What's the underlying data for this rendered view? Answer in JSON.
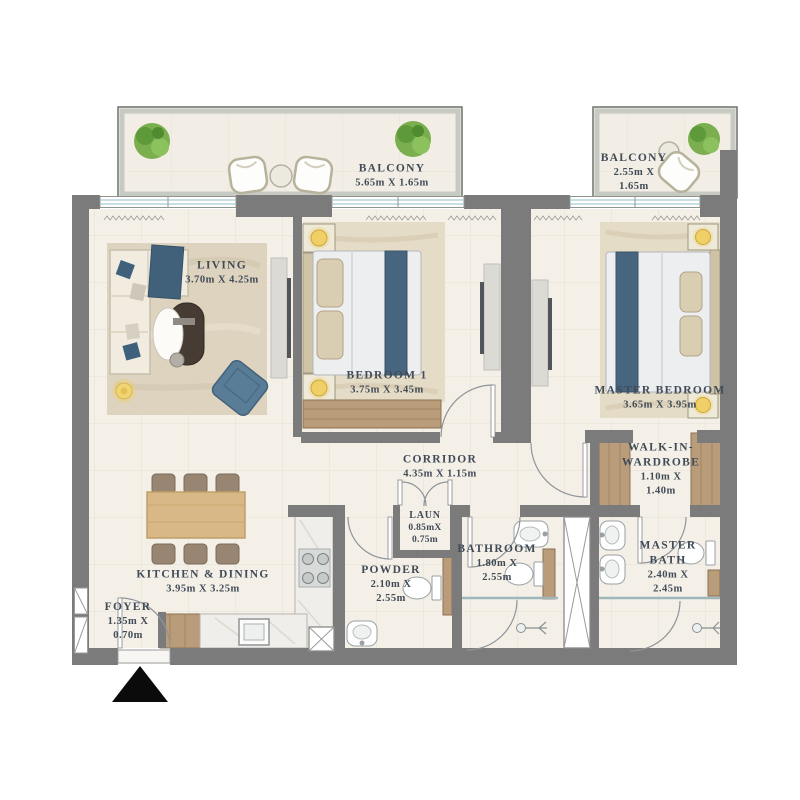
{
  "title": "Apartment floor plan",
  "palette": {
    "wall": "#7b7b7b",
    "floor": "#f4f0e8",
    "tile_line": "#e6e1d4",
    "balcony_floor": "#f2eee5",
    "balcony_wall": "#c6cac2",
    "text": "#414b57",
    "wood": "#b99c79",
    "wood_light": "#d9b887",
    "accent_blue": "#47657f",
    "armchair_blue": "#5a7d97",
    "rug": "#ddd3bf",
    "bed_texture": "#e5dcc8",
    "plant_green": "#7aae4e",
    "lamp_yellow": "#f0cf66",
    "window_glass": "#a9ccd6",
    "fixture_outline": "#9aa0a4",
    "counter_marble": "#f0eeea",
    "tv_dark": "#50555a",
    "entrance_marker": "#0b0b0b"
  },
  "icons": {
    "entrance_marker": "black-triangle",
    "plants": "potted-plant",
    "shower": "shower-head",
    "duct": "crossed-shaft"
  },
  "labels": {
    "balcony_main": {
      "lines": [
        "BALCONY",
        "5.65m X 1.65m"
      ]
    },
    "balcony_master": {
      "lines": [
        "BALCONY",
        "2.55m X",
        "1.65m"
      ]
    },
    "living": {
      "lines": [
        "LIVING",
        "3.70m X 4.25m"
      ]
    },
    "bedroom1": {
      "lines": [
        "BEDROOM 1",
        "3.75m X 3.45m"
      ]
    },
    "master_bedroom": {
      "lines": [
        "MASTER BEDROOM",
        "3.65m X 3.95m"
      ]
    },
    "corridor": {
      "lines": [
        "CORRIDOR",
        "4.35m X 1.15m"
      ]
    },
    "laundry": {
      "lines": [
        "LAUN",
        "0.85mX",
        "0.75m"
      ]
    },
    "bathroom": {
      "lines": [
        "BATHROOM",
        "1.80m X",
        "2.55m"
      ]
    },
    "walk_in": {
      "lines": [
        "WALK-IN-",
        "WARDROBE",
        "1.10m X",
        "1.40m"
      ]
    },
    "master_bath": {
      "lines": [
        "MASTER",
        "BATH",
        "2.40m X",
        "2.45m"
      ]
    },
    "kitchen": {
      "lines": [
        "KITCHEN & DINING",
        "3.95m X 3.25m"
      ]
    },
    "powder": {
      "lines": [
        "POWDER",
        "2.10m X",
        "2.55m"
      ]
    },
    "foyer": {
      "lines": [
        "FOYER",
        "1.35m X",
        "0.70m"
      ]
    }
  }
}
